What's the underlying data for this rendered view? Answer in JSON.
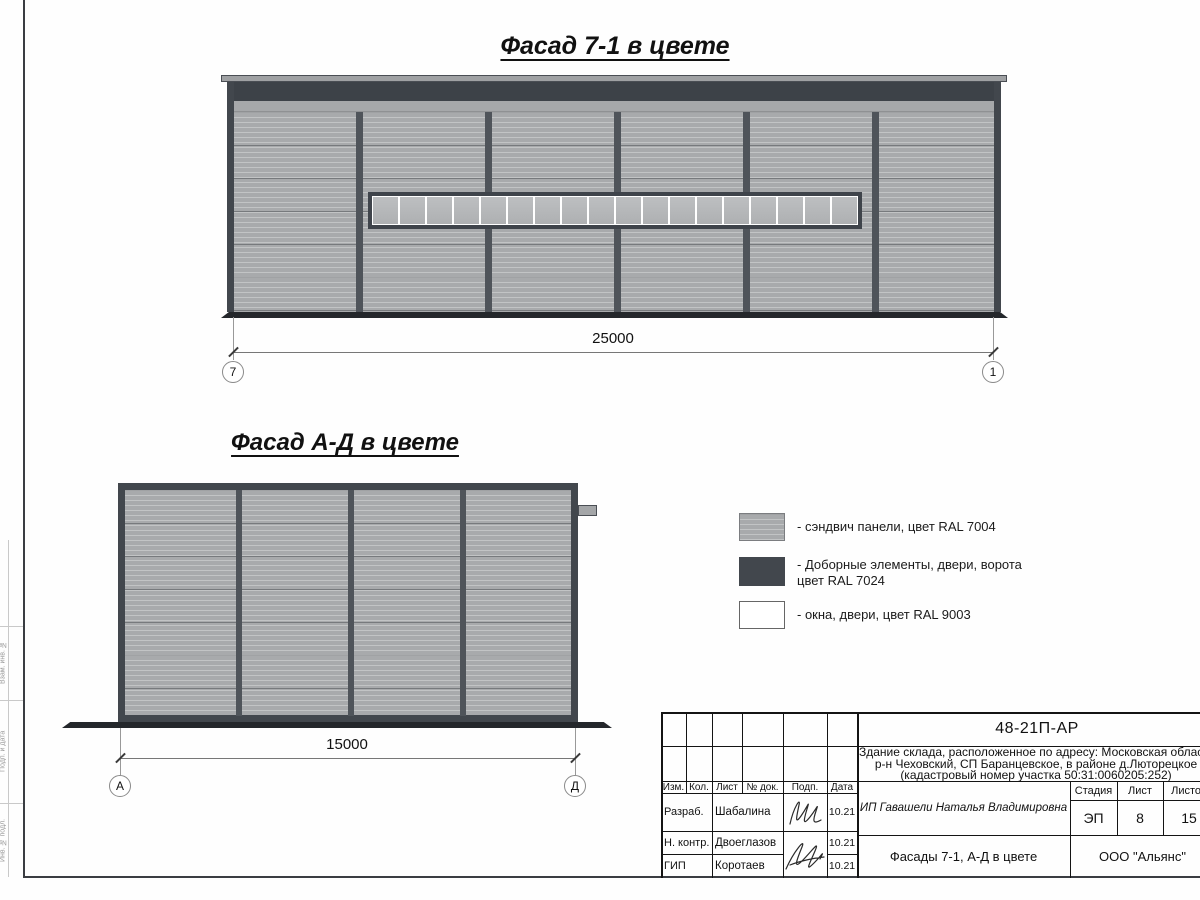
{
  "drawing": {
    "facade_7_1": {
      "title": "Фасад 7-1 в цвете",
      "dimension": "25000",
      "axis_left": "7",
      "axis_right": "1"
    },
    "facade_a_d": {
      "title": "Фасад А-Д в цвете",
      "dimension": "15000",
      "axis_left": "А",
      "axis_right": "Д"
    },
    "legend": {
      "items": [
        {
          "label": "- сэндвич панели, цвет RAL 7004",
          "swatch_color": "#a8aaac"
        },
        {
          "label_line1": "- Доборные элементы, двери, ворота",
          "label_line2": "цвет RAL 7024",
          "swatch_color": "#42474d"
        },
        {
          "label": "- окна, двери, цвет RAL 9003",
          "swatch_color": "#ffffff"
        }
      ]
    },
    "colors": {
      "panels_ral7004": "#a8aaac",
      "trim_ral7024": "#42474d",
      "windows_ral9003": "#ffffff",
      "plinth": "#24272b"
    },
    "margin_labels": [
      "Взам. инв. №",
      "Подп. и дата",
      "Инв. № подл."
    ],
    "title_block": {
      "doc_number": "48-21П-АР",
      "description_line1": "Здание склада, расположенное по адресу: Московская область,",
      "description_line2": "р-н Чеховский, СП Баранцевское, в районе д.Люторецкое",
      "description_line3": "(кадастровый номер участка 50:31:0060205:252)",
      "header_cols": [
        "Изм.",
        "Кол.",
        "Лист",
        "№ док.",
        "Подп.",
        "Дата"
      ],
      "rows": [
        {
          "role": "Разраб.",
          "name": "Шабалина",
          "date": "10.21"
        },
        {
          "role": "Н. контр.",
          "name": "Двоеглазов",
          "date": "10.21"
        },
        {
          "role": "ГИП",
          "name": "Коротаев",
          "date": "10.21"
        }
      ],
      "client": "ИП Гавашели Наталья Владимировна",
      "stage_label": "Стадия",
      "sheet_label": "Лист",
      "sheets_label": "Листов",
      "stage_value": "ЭП",
      "sheet_value": "8",
      "sheets_value": "15",
      "drawing_title": "Фасады 7-1, А-Д в цвете",
      "company": "ООО \"Альянс\""
    }
  }
}
